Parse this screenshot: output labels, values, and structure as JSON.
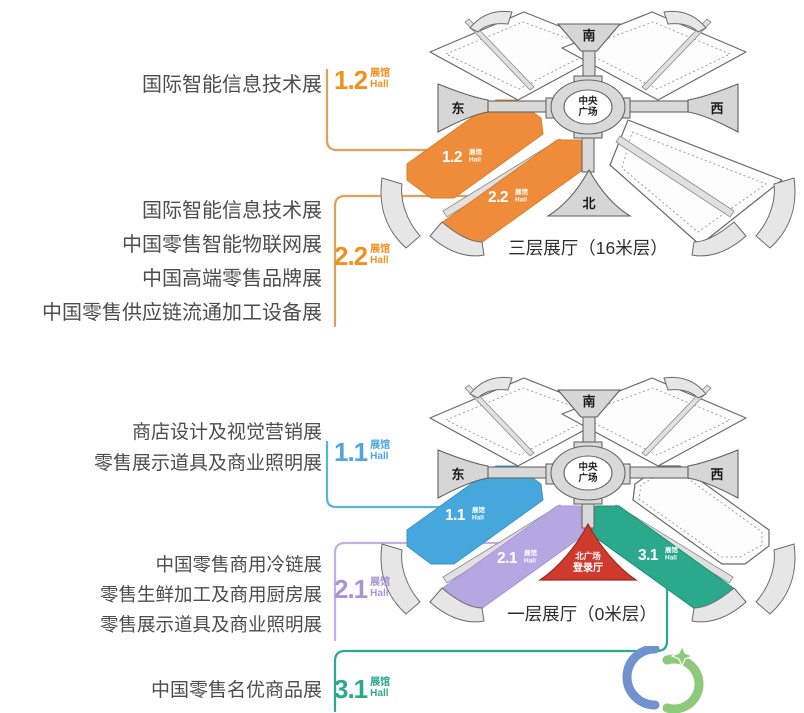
{
  "colors": {
    "orange": "#EE8C3B",
    "orange_stroke": "#D87F28",
    "orange_text": "#F0921E",
    "orange_line": "#DFA258",
    "blue": "#45A7DB",
    "blue_stroke": "#3E96C8",
    "blue_line": "#57B4DC",
    "purple": "#B6A6E2",
    "purple_stroke": "#A693D6",
    "purple_line": "#C2B2E2",
    "teal": "#2AA98D",
    "teal_stroke": "#1D8F75",
    "red": "#CE3A2E",
    "red_stroke": "#9E2A1F",
    "label_text": "#4D4D4D",
    "logo_blue": "#7291CF",
    "logo_green": "#8FC97B"
  },
  "top": {
    "caption": "三层展厅（16米层）",
    "groups": [
      {
        "lines": [
          "国际智能信息技术展"
        ],
        "num": "1.2",
        "unit_cn": "展馆",
        "unit_en": "Hall"
      },
      {
        "lines": [
          "国际智能信息技术展",
          "中国零售智能物联网展",
          "中国高端零售品牌展",
          "中国零售供应链流通加工设备展"
        ],
        "num": "2.2",
        "unit_cn": "展馆",
        "unit_en": "Hall"
      }
    ],
    "map": {
      "south": "南",
      "east": "东",
      "west": "西",
      "north": "北",
      "center_line1": "中央",
      "center_line2": "广场",
      "halls": [
        {
          "num": "1.2",
          "unit_cn": "展馆",
          "unit_en": "Hall"
        },
        {
          "num": "2.2",
          "unit_cn": "展馆",
          "unit_en": "Hall"
        }
      ]
    }
  },
  "bottom": {
    "caption": "一层展厅（0米层）",
    "groups": [
      {
        "lines": [
          "商店设计及视觉营销展",
          "零售展示道具及商业照明展"
        ],
        "num": "1.1",
        "unit_cn": "展馆",
        "unit_en": "Hall"
      },
      {
        "lines": [
          "中国零售商用冷链展",
          "零售生鲜加工及商用厨房展",
          "零售展示道具及商业照明展"
        ],
        "num": "2.1",
        "unit_cn": "展馆",
        "unit_en": "Hall"
      },
      {
        "lines": [
          "中国零售名优商品展"
        ],
        "num": "3.1",
        "unit_cn": "展馆",
        "unit_en": "Hall"
      }
    ],
    "map": {
      "south": "南",
      "east": "东",
      "west": "西",
      "center_line1": "中央",
      "center_line2": "广场",
      "entry_line1": "北广场",
      "entry_line2": "登录厅",
      "halls": [
        {
          "num": "1.1",
          "unit_cn": "展馆",
          "unit_en": "Hall"
        },
        {
          "num": "2.1",
          "unit_cn": "展馆",
          "unit_en": "Hall"
        },
        {
          "num": "3.1",
          "unit_cn": "展馆",
          "unit_en": "Hall"
        }
      ]
    }
  }
}
